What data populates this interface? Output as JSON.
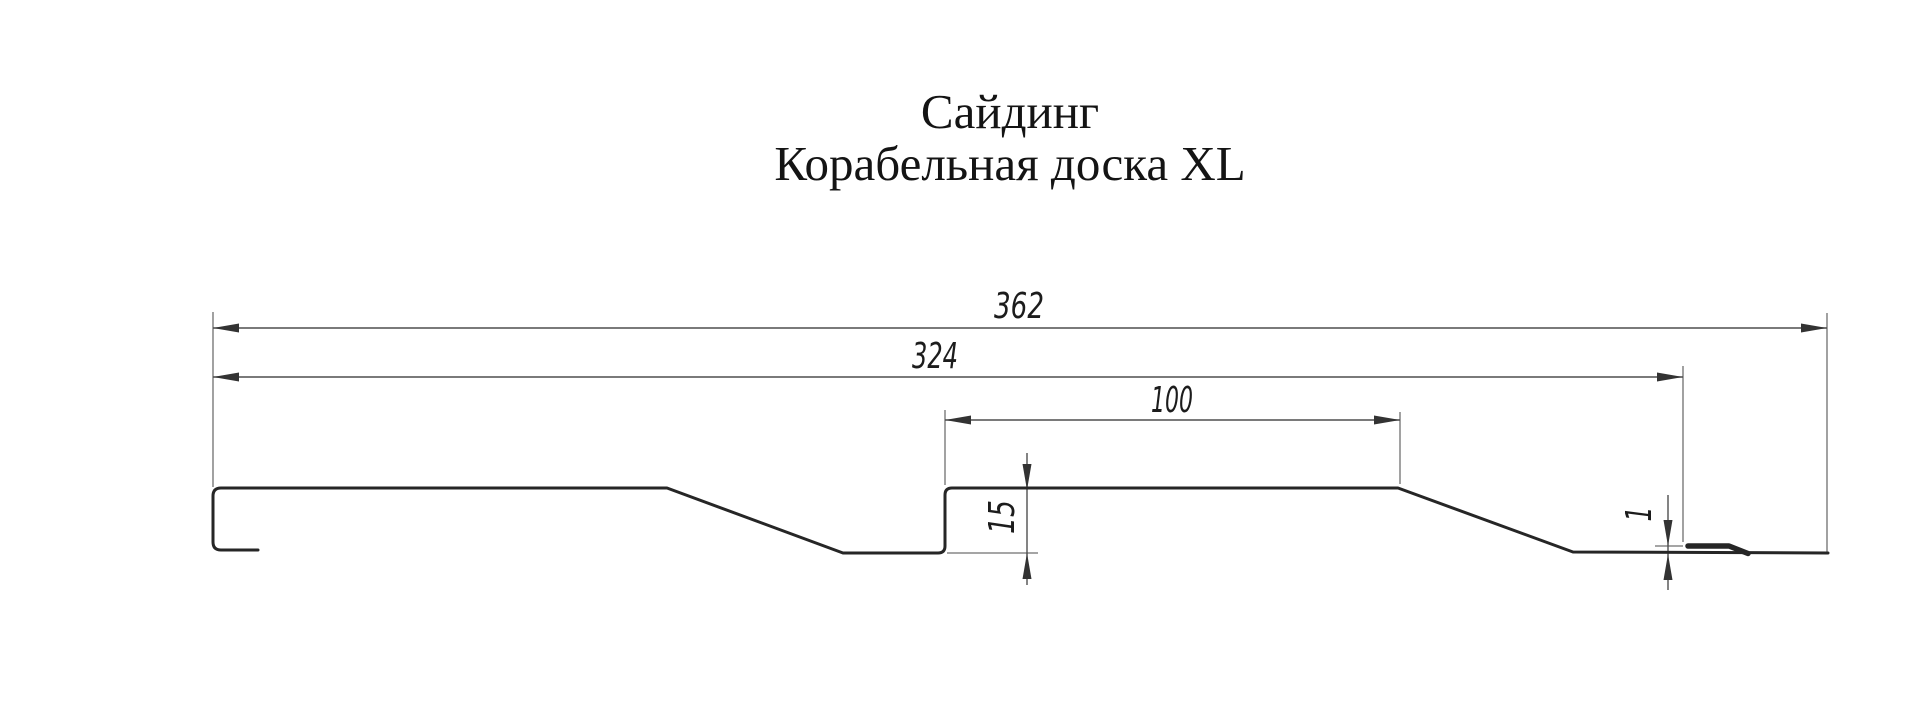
{
  "title": {
    "line1": "Сайдинг",
    "line2": "Корабельная доска XL"
  },
  "dimensions": {
    "overall_width_mm": "362",
    "panel_cover_width_mm": "324",
    "plank_top_width_mm": "100",
    "profile_depth_mm": "15",
    "hem_offset_mm": "1"
  },
  "colors": {
    "background": "#ffffff",
    "profile_line": "#262626",
    "dimension_line": "#4f4f4f",
    "extension_line": "#6f6f6f",
    "text": "#1c1c1c"
  }
}
